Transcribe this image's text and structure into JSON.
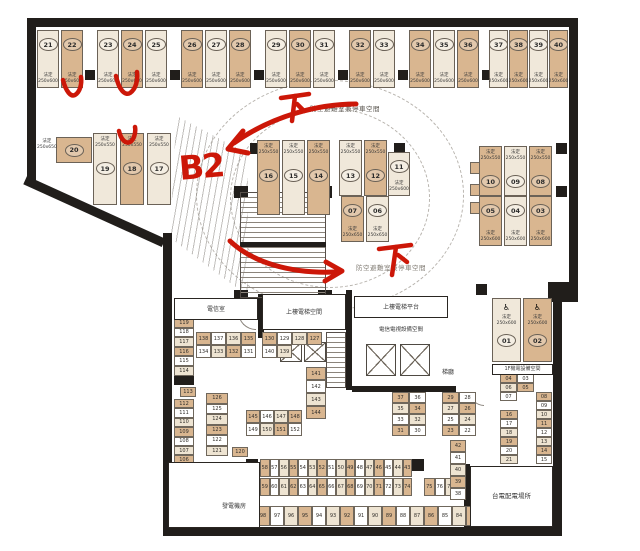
{
  "colors": {
    "tan": "#d9b690",
    "cream": "#f0e8da",
    "wall": "#211e1b",
    "red": "#cc1708"
  },
  "legal_label": "法定",
  "accessible_icon": "♿",
  "annotations": {
    "b2": "B2",
    "down_top": "下",
    "down_mid": "下",
    "check_note": "red check marks above stalls 22, 24 and 18",
    "shelter_top": "防空避難室兼停車空間",
    "shelter_mid": "防空避難室兼停車空間"
  },
  "parking": {
    "groups": [
      {
        "x": 37,
        "y": 30,
        "w": 22,
        "step": 24,
        "h": 58,
        "lp": "b",
        "size": "250x600",
        "stalls": [
          [
            "21",
            "c"
          ],
          [
            "22",
            "t"
          ]
        ]
      },
      {
        "x": 97,
        "y": 30,
        "w": 22,
        "step": 24,
        "h": 58,
        "lp": "b",
        "size": "250x600",
        "stalls": [
          [
            "23",
            "c"
          ],
          [
            "24",
            "t"
          ],
          [
            "25",
            "c"
          ]
        ]
      },
      {
        "x": 181,
        "y": 30,
        "w": 22,
        "step": 24,
        "h": 58,
        "lp": "b",
        "size": "250x600",
        "stalls": [
          [
            "26",
            "t"
          ],
          [
            "27",
            "c"
          ],
          [
            "28",
            "t"
          ]
        ]
      },
      {
        "x": 265,
        "y": 30,
        "w": 22,
        "step": 24,
        "h": 58,
        "lp": "b",
        "size": "250x600",
        "stalls": [
          [
            "29",
            "c"
          ],
          [
            "30",
            "t"
          ],
          [
            "31",
            "c"
          ]
        ]
      },
      {
        "x": 349,
        "y": 30,
        "w": 22,
        "step": 24,
        "h": 58,
        "lp": "b",
        "size": "250x600",
        "stalls": [
          [
            "32",
            "t"
          ],
          [
            "33",
            "c"
          ]
        ]
      },
      {
        "x": 409,
        "y": 30,
        "w": 22,
        "step": 24,
        "h": 58,
        "lp": "b",
        "size": "250x600",
        "stalls": [
          [
            "34",
            "t"
          ],
          [
            "35",
            "c"
          ],
          [
            "36",
            "t"
          ]
        ]
      },
      {
        "x": 489,
        "y": 30,
        "w": 19,
        "step": 20,
        "h": 58,
        "lp": "b",
        "size": "250x600",
        "stalls": [
          [
            "37",
            "c"
          ],
          [
            "38",
            "t"
          ],
          [
            "39",
            "c"
          ],
          [
            "40",
            "t"
          ]
        ]
      },
      {
        "x": 93,
        "y": 133,
        "w": 24,
        "step": 27,
        "h": 72,
        "lp": "t",
        "size": "250x550",
        "stalls": [
          [
            "19",
            "c"
          ],
          [
            "18",
            "t"
          ],
          [
            "17",
            "c"
          ]
        ]
      },
      {
        "x": 257,
        "y": 140,
        "w": 23,
        "step": 25,
        "h": 75,
        "lp": "t",
        "size": "250x550",
        "stalls": [
          [
            "16",
            "t"
          ],
          [
            "15",
            "c"
          ],
          [
            "14",
            "t"
          ]
        ]
      },
      {
        "x": 339,
        "y": 140,
        "w": 23,
        "step": 25,
        "h": 56,
        "lp": "t",
        "size": "250x550",
        "stalls": [
          [
            "13",
            "c"
          ],
          [
            "12",
            "t"
          ]
        ]
      },
      {
        "x": 388,
        "y": 152,
        "w": 22,
        "step": 0,
        "h": 44,
        "lp": "b",
        "size": "250x600",
        "stalls": [
          [
            "11",
            "c"
          ]
        ]
      },
      {
        "x": 341,
        "y": 196,
        "w": 23,
        "step": 25,
        "h": 46,
        "lp": "b",
        "size": "250x650",
        "stalls": [
          [
            "07",
            "t"
          ],
          [
            "06",
            "c"
          ]
        ]
      },
      {
        "x": 479,
        "y": 146,
        "w": 23,
        "step": 25,
        "h": 50,
        "lp": "t",
        "size": "250x550",
        "stalls": [
          [
            "10",
            "t"
          ],
          [
            "09",
            "c"
          ],
          [
            "08",
            "t"
          ]
        ]
      },
      {
        "x": 479,
        "y": 196,
        "w": 23,
        "step": 25,
        "h": 50,
        "lp": "b",
        "size": "250x600",
        "stalls": [
          [
            "05",
            "t"
          ],
          [
            "04",
            "c"
          ],
          [
            "03",
            "t"
          ]
        ]
      },
      {
        "x": 492,
        "y": 298,
        "w": 29,
        "step": 31,
        "h": 64,
        "lp": "a",
        "size": "250x600",
        "stalls": [
          [
            "01",
            "c"
          ],
          [
            "02",
            "t"
          ]
        ]
      },
      {
        "x": 56,
        "y": 137,
        "w": 36,
        "step": 0,
        "h": 26,
        "lp": "r",
        "size": "250x650",
        "stalls": [
          [
            "20",
            "t"
          ]
        ]
      }
    ]
  },
  "free_labels": [
    {
      "x": 37,
      "y": 139,
      "l1": "法定",
      "l2": "250x650"
    }
  ],
  "mini_clusters": [
    {
      "x": 174,
      "y": 318,
      "cols": 1,
      "cw": 20,
      "ch": 9.6,
      "nums": [
        "119",
        "118",
        "117",
        "116",
        "115",
        "114"
      ]
    },
    {
      "x": 180,
      "y": 387,
      "cols": 1,
      "cw": 16,
      "ch": 10,
      "nums": [
        "113"
      ]
    },
    {
      "x": 174,
      "y": 399,
      "cols": 1,
      "cw": 20,
      "ch": 9.4,
      "nums": [
        "112",
        "111",
        "110",
        "109",
        "108",
        "107",
        "106",
        "105"
      ]
    },
    {
      "x": 196,
      "y": 332,
      "cols": 4,
      "cw": 15,
      "ch": 13,
      "nums": [
        "138",
        "137",
        "136",
        "135",
        "134",
        "133",
        "132",
        "131"
      ]
    },
    {
      "x": 262,
      "y": 332,
      "cols": 4,
      "cw": 15,
      "ch": 13,
      "nums": [
        "130",
        "129",
        "128",
        "127",
        "140",
        "139",
        null,
        null
      ]
    },
    {
      "x": 206,
      "y": 393,
      "cols": 1,
      "cw": 22,
      "ch": 10.5,
      "nums": [
        "126",
        "125",
        "124",
        "123",
        "122",
        "121"
      ]
    },
    {
      "x": 232,
      "y": 447,
      "cols": 1,
      "cw": 16,
      "ch": 10,
      "nums": [
        "120"
      ]
    },
    {
      "x": 306,
      "y": 367,
      "cols": 1,
      "cw": 20,
      "ch": 13,
      "nums": [
        "141",
        "142",
        "143",
        "144"
      ]
    },
    {
      "x": 246,
      "y": 410,
      "cols": 4,
      "cw": 14,
      "ch": 13,
      "nums": [
        "145",
        "146",
        "147",
        "148",
        "149",
        "150",
        "151",
        "152"
      ]
    },
    {
      "x": 196,
      "y": 470,
      "cols": 6,
      "cw": 10,
      "ch": 16,
      "nums": [
        "153",
        "154",
        "155",
        "156",
        "157",
        "158"
      ]
    },
    {
      "x": 260,
      "y": 459,
      "cols": 16,
      "cw": 9.5,
      "ch": 18,
      "nums": [
        "58",
        "57",
        "56",
        "55",
        "54",
        "53",
        "52",
        "51",
        "50",
        "49",
        "48",
        "47",
        "46",
        "45",
        "44",
        "43"
      ]
    },
    {
      "x": 260,
      "y": 478,
      "cols": 16,
      "cw": 9.5,
      "ch": 18,
      "nums": [
        "59",
        "60",
        "61",
        "62",
        "63",
        "64",
        "65",
        "66",
        "67",
        "68",
        "69",
        "70",
        "71",
        "72",
        "73",
        "74"
      ]
    },
    {
      "x": 424,
      "y": 478,
      "cols": 3,
      "cw": 10.5,
      "ch": 18,
      "nums": [
        "75",
        "76",
        "77"
      ]
    },
    {
      "x": 256,
      "y": 506,
      "cols": 21,
      "cw": 14,
      "ch": 20,
      "nums": [
        "98",
        "97",
        "96",
        "95",
        "94",
        "93",
        "92",
        "91",
        "90",
        "89",
        "88",
        "87",
        "86",
        "85",
        "84",
        "83",
        "82",
        "81",
        "80",
        "79",
        "78"
      ]
    },
    {
      "x": 392,
      "y": 392,
      "cols": 2,
      "cw": 17,
      "ch": 11,
      "nums": [
        "37",
        "36",
        "35",
        "34",
        "33",
        "32",
        "31",
        "30"
      ]
    },
    {
      "x": 442,
      "y": 392,
      "cols": 2,
      "cw": 17,
      "ch": 11,
      "nums": [
        "29",
        "28",
        "27",
        "26",
        "25",
        "24",
        "23",
        "22"
      ]
    },
    {
      "x": 450,
      "y": 440,
      "cols": 1,
      "cw": 16,
      "ch": 12,
      "nums": [
        "42",
        "41",
        "40",
        "39",
        "38"
      ]
    },
    {
      "x": 500,
      "y": 410,
      "cols": 1,
      "cw": 18,
      "ch": 9,
      "nums": [
        "16",
        "17",
        "18",
        "19",
        "20",
        "21"
      ]
    },
    {
      "x": 536,
      "y": 392,
      "cols": 1,
      "cw": 16,
      "ch": 9,
      "nums": [
        "08",
        "09",
        "10",
        "11",
        "12",
        "13",
        "14",
        "15"
      ]
    },
    {
      "x": 500,
      "y": 374,
      "cols": 2,
      "cw": 17,
      "ch": 9,
      "nums": [
        "04",
        "03",
        "06",
        "05",
        "07",
        null
      ]
    }
  ],
  "rooms": [
    {
      "id": "telecom",
      "label": "電信室",
      "x": 174,
      "y": 298,
      "w": 84,
      "h": 22,
      "fs": 6,
      "bordered": true
    },
    {
      "id": "elev-up",
      "label": "上樓電梯空間",
      "x": 262,
      "y": 294,
      "w": 84,
      "h": 36,
      "fs": 6,
      "bordered": true
    },
    {
      "id": "elev-platform",
      "label": "上樓電梯平台",
      "x": 354,
      "y": 296,
      "w": 94,
      "h": 22,
      "fs": 6,
      "bordered": true
    },
    {
      "id": "tv-equip",
      "label": "電信電視設備空間",
      "x": 352,
      "y": 324,
      "w": 98,
      "h": 12,
      "fs": 5.5,
      "bordered": false
    },
    {
      "id": "stair-lobby",
      "label": "梯廳",
      "x": 430,
      "y": 366,
      "w": 36,
      "h": 13,
      "fs": 6,
      "bordered": false
    },
    {
      "id": "generator",
      "label": "發電機房",
      "x": 168,
      "y": 462,
      "w": 92,
      "h": 66,
      "fs": 6,
      "bordered": true,
      "ly": 40
    },
    {
      "id": "taipower",
      "label": "台電配電場所",
      "x": 470,
      "y": 466,
      "w": 83,
      "h": 61,
      "fs": 6.5,
      "bordered": true
    },
    {
      "id": "mech-1f",
      "label": "1F機電設備空間",
      "x": 492,
      "y": 364,
      "w": 61,
      "h": 11,
      "fs": 5,
      "bordered": true
    }
  ]
}
